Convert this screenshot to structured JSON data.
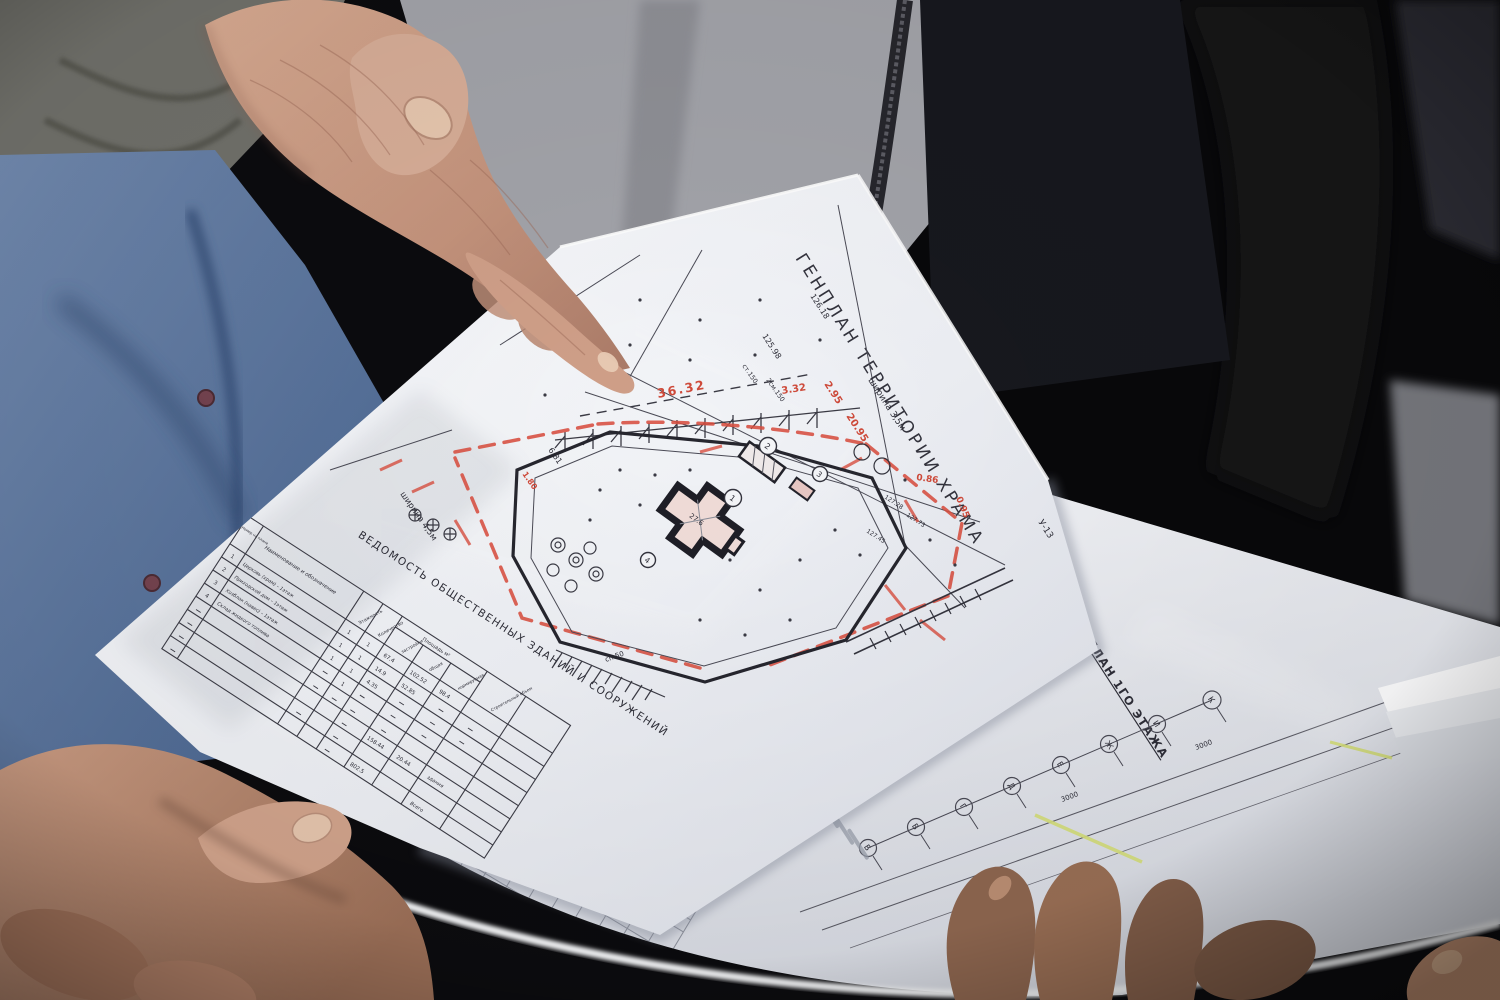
{
  "colors": {
    "paper": "#f4f5f8",
    "red_marking": "#cf4a3a",
    "green_spine": "#2fa65b",
    "blue_shirt": "#5b79a5",
    "drawing_line": "#34343e"
  },
  "sheet1": {
    "title": "ГЕНПЛАН ТЕРРИТОРИИ ХРАМА",
    "red_marks": [
      "36.32",
      "3.32",
      "2.95",
      "20.95",
      "0.86",
      "0.95",
      "1.80"
    ],
    "black_marks": [
      "ширина 3,5м",
      "ширина 4,5м",
      "126.18",
      "125.98",
      "6.81",
      "У-13",
      "сп.50",
      "127.28",
      "127.73",
      "127.45",
      "2см.150",
      "ст.150",
      "27.6"
    ],
    "building_markers": [
      "1",
      "2",
      "3",
      "4"
    ],
    "table": {
      "title": "ВЕДОМОСТЬ ОБЩЕСТВЕННЫХ ЗДАНИЙ И СООРУЖЕНИЙ",
      "headers": {
        "num": "Номер на плане",
        "name": "Наименование и обозначение",
        "floors": "Этажность",
        "qty": "Количество",
        "area": "Площадь м²",
        "footprint": "застройки",
        "total": "общая",
        "usable": "нормируемая",
        "volume": "Строительный объем"
      },
      "rows": [
        {
          "num": "1",
          "name": "Церковь (храм) – 1этаж",
          "floors": "1",
          "qty": "1",
          "footprint": "67.4",
          "total": "102.52",
          "usable": "98.4"
        },
        {
          "num": "2",
          "name": "Приходской дом – 1этаж",
          "floors": "1",
          "qty": "1",
          "footprint": "14.9",
          "total": "52.85",
          "usable": ""
        },
        {
          "num": "3",
          "name": "Хозблок (навес) – 1этаж",
          "floors": "1",
          "qty": "1",
          "footprint": "4.35",
          "total": "",
          "usable": ""
        },
        {
          "num": "4",
          "name": "Склад жидкого топлива",
          "floors": "",
          "qty": "1",
          "footprint": "",
          "total": "",
          "usable": ""
        }
      ],
      "summary": [
        {
          "total": "158.44",
          "usable": "20.44",
          "note": "здания"
        },
        {
          "total": "802.5",
          "usable": "",
          "note": "Всего"
        }
      ]
    }
  },
  "sheet2": {
    "title": "ПЛАН 1ГО ЭТАЖА",
    "axes": [
      "К",
      "И",
      "Ж",
      "Е",
      "Д",
      "Г",
      "В",
      "Б"
    ],
    "dims": [
      "3000",
      "3000"
    ]
  }
}
